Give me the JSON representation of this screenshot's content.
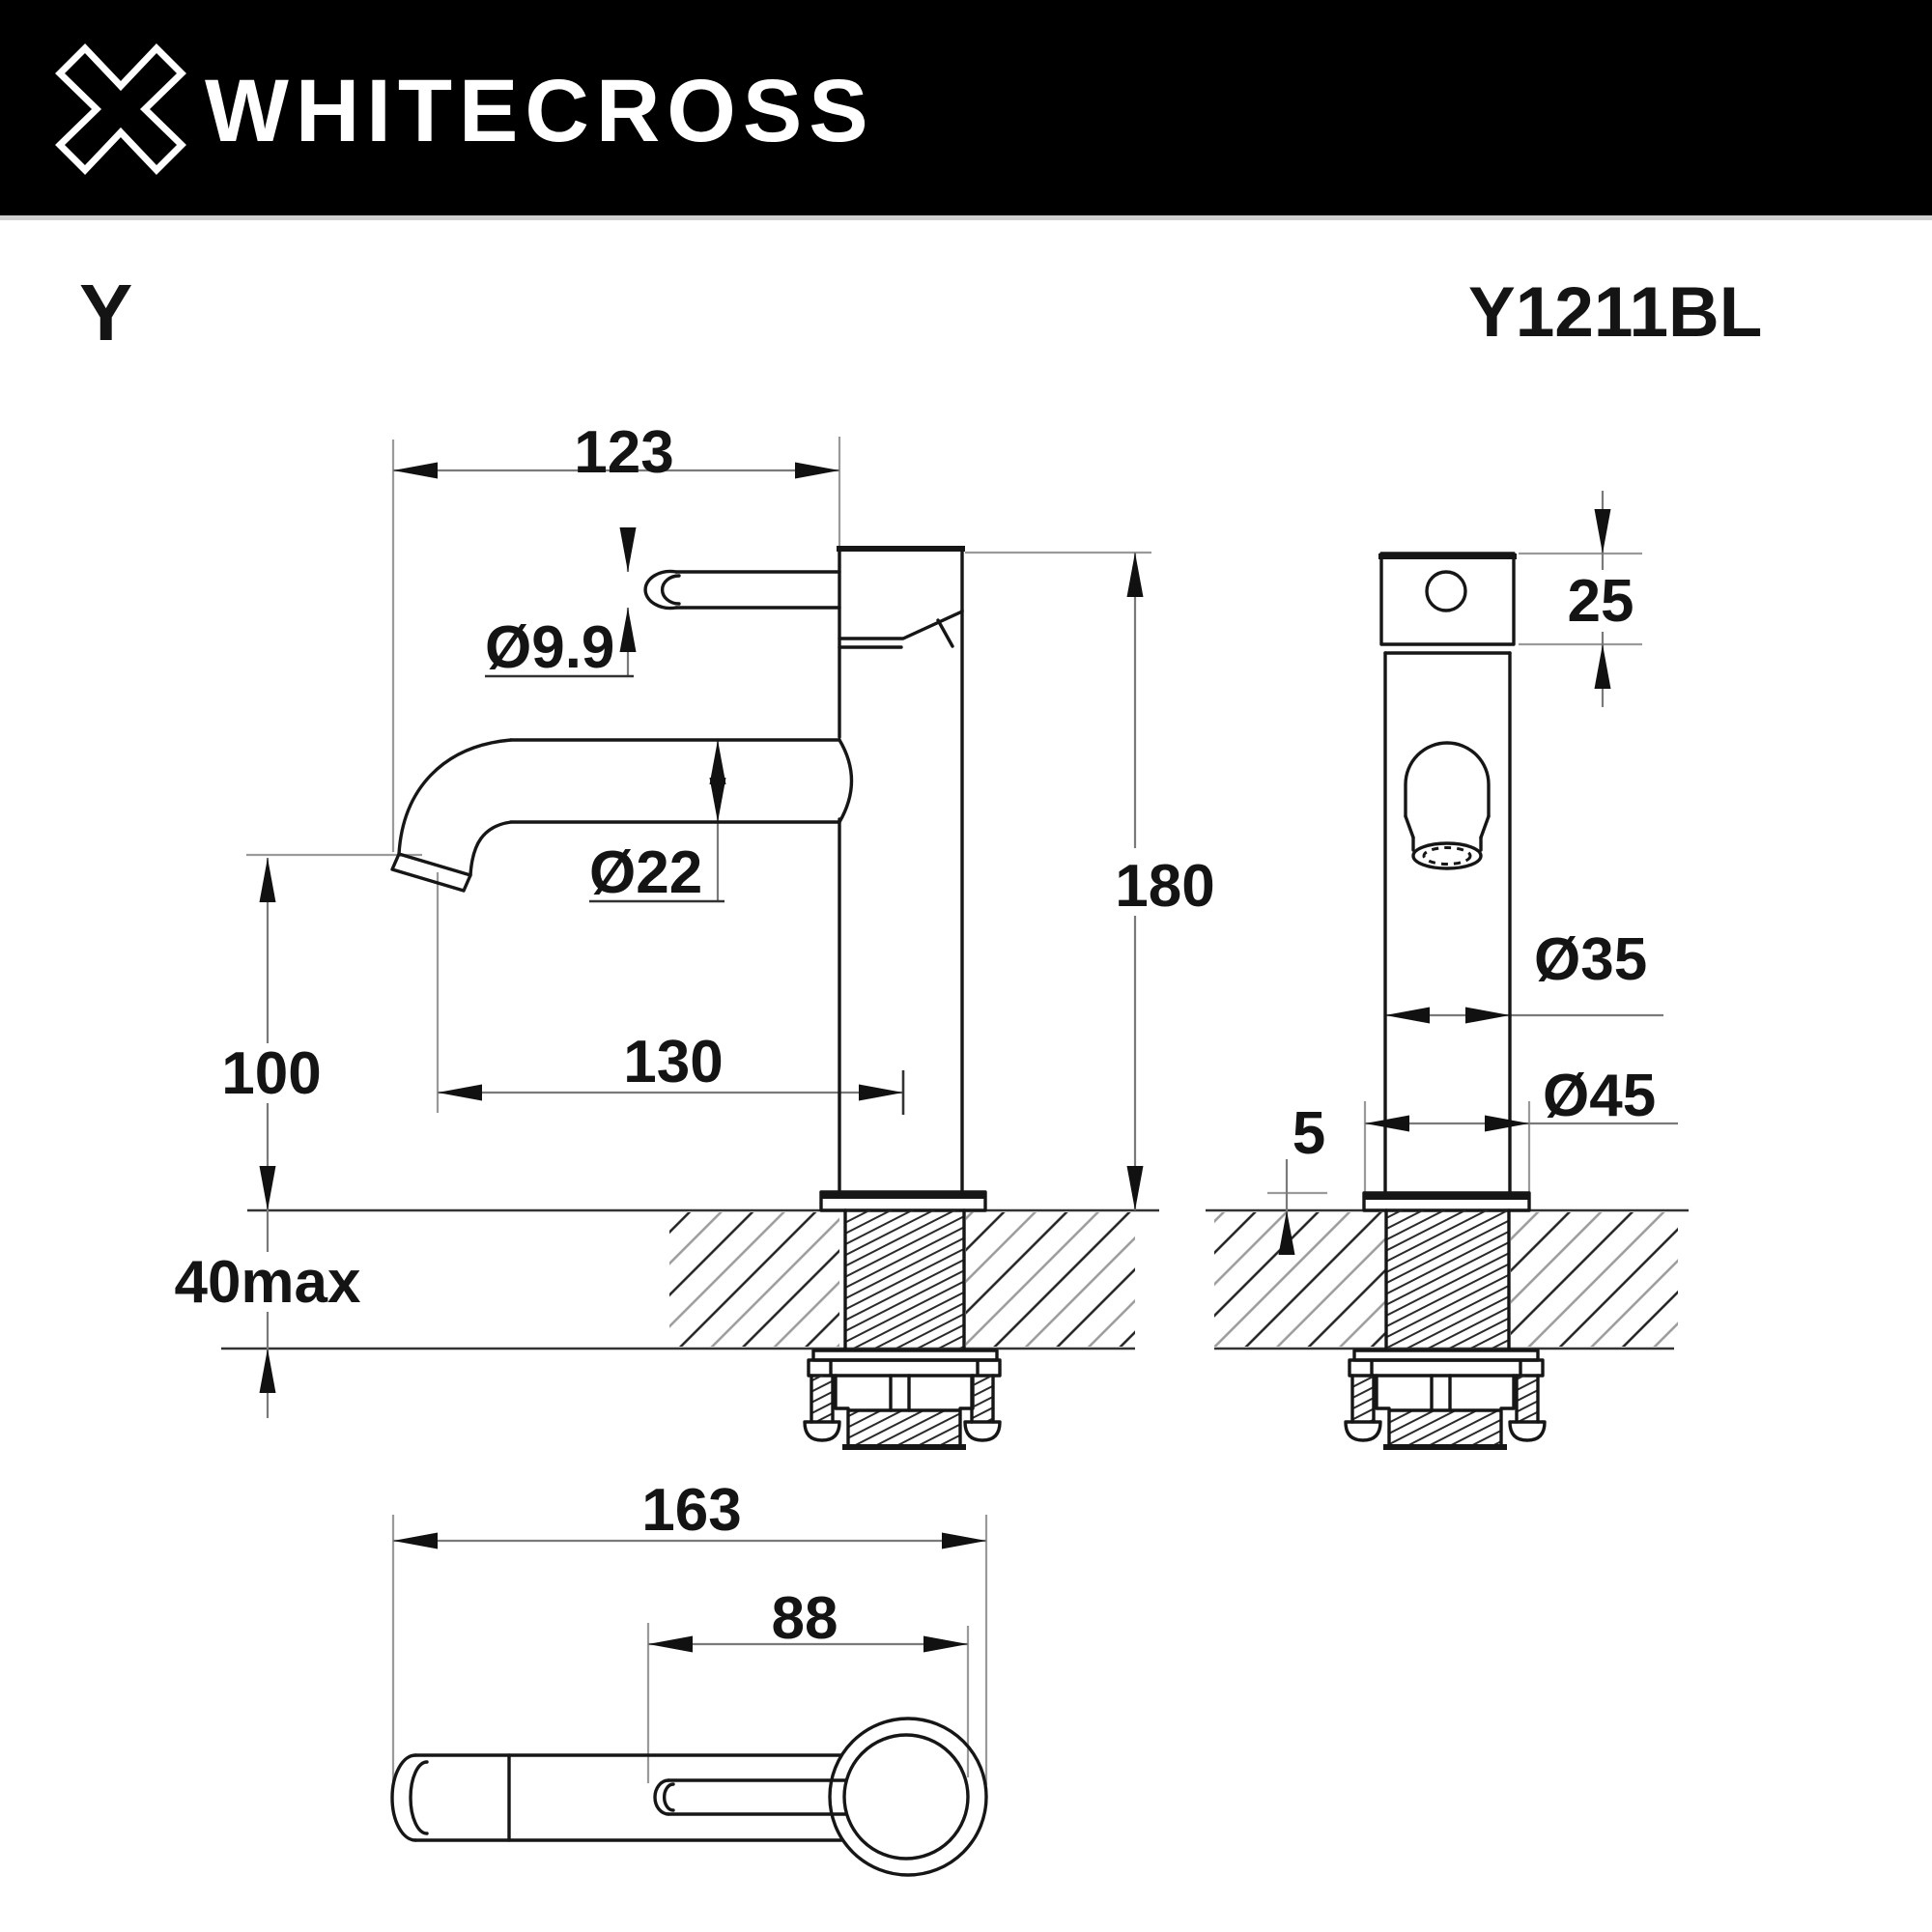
{
  "header": {
    "brand": "WHITECROSS",
    "logo": "whitecross-x-logo"
  },
  "title": {
    "series": "Y",
    "model": "Y1211BL"
  },
  "dimensions": {
    "front": {
      "spout_reach": "123",
      "handle_dia": "Ø9.9",
      "spout_dia": "Ø22",
      "total_height": "180",
      "outlet_height": "100",
      "center_reach": "130",
      "deck_max": "40max"
    },
    "side": {
      "head_height": "25",
      "body_dia": "Ø35",
      "flange_dia": "Ø45",
      "flange_lip": "5"
    },
    "top": {
      "overall_length": "163",
      "handle_length": "88"
    }
  },
  "colors": {
    "header_bg": "#000000",
    "paper": "#ffffff",
    "line": "#161616",
    "dim_line": "#7a7a7a"
  }
}
